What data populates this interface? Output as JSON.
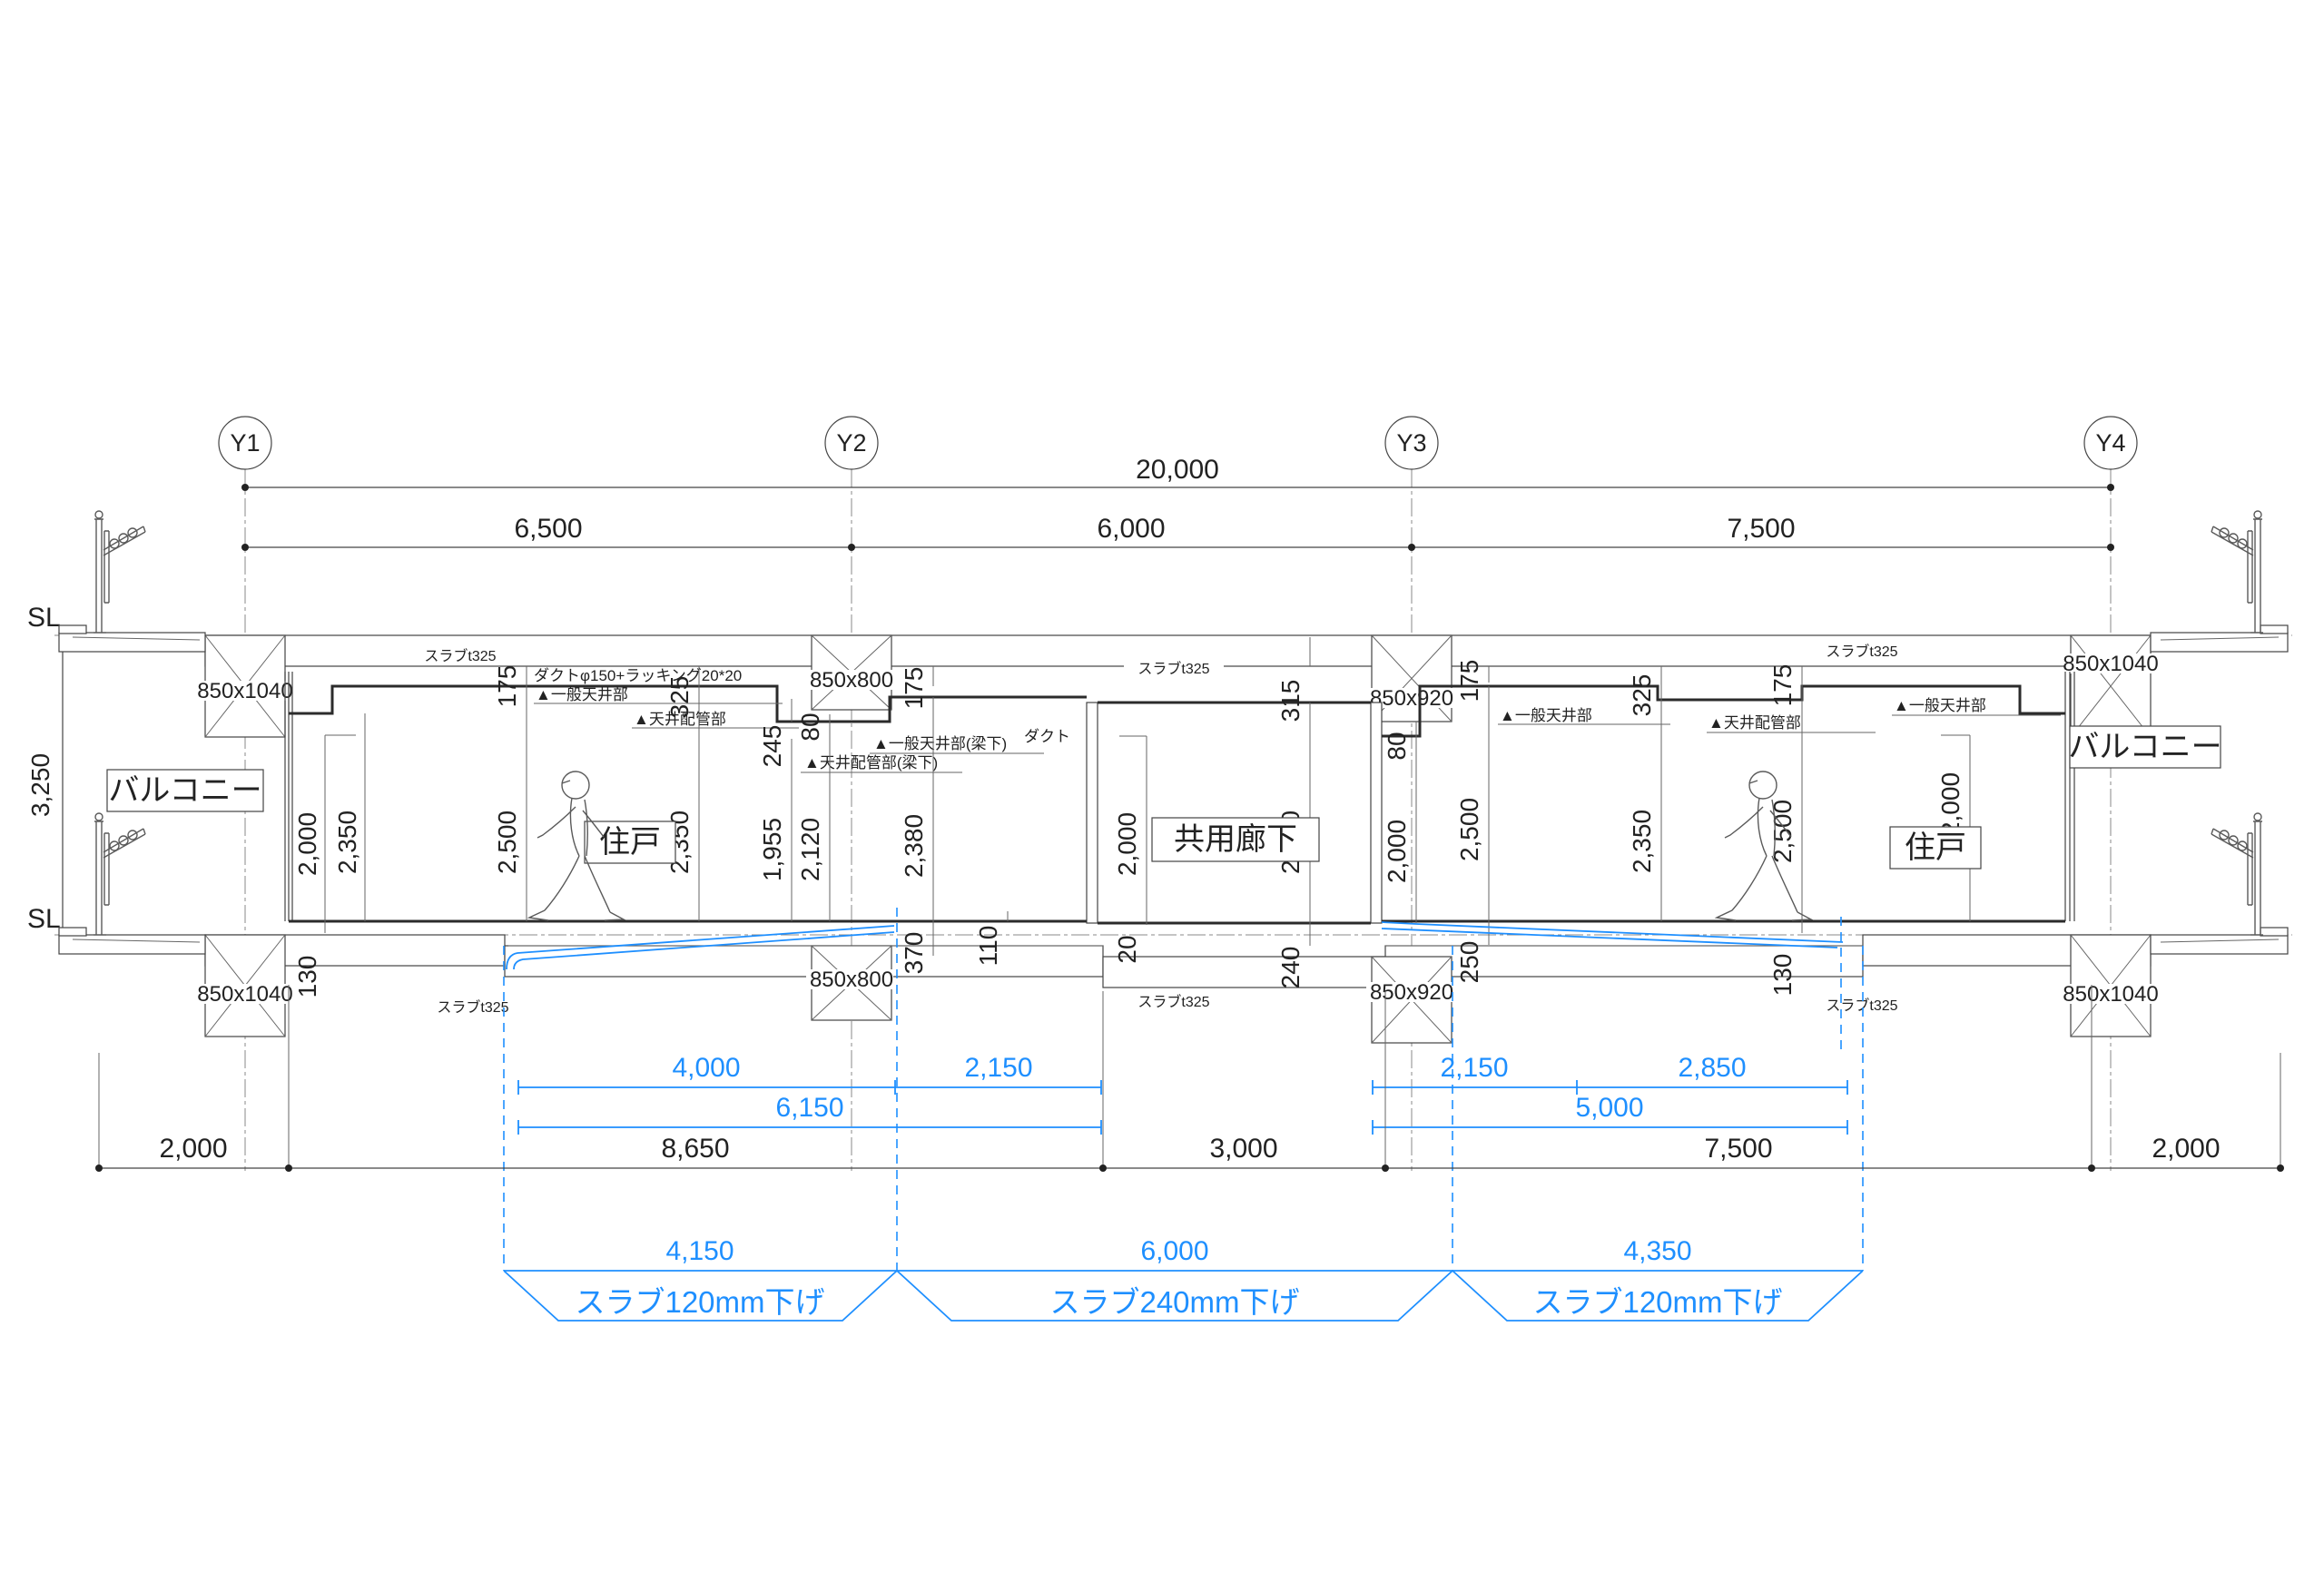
{
  "grid": {
    "labels": [
      "Y1",
      "Y2",
      "Y3",
      "Y4"
    ]
  },
  "dims": {
    "overall": "20,000",
    "spans": [
      "6,500",
      "6,000",
      "7,500"
    ],
    "height_left": "3,250",
    "sl": "SL",
    "bottom": [
      "2,000",
      "8,650",
      "3,000",
      "7,500",
      "2,000"
    ]
  },
  "rooms": {
    "balcony": "バルコニー",
    "unit": "住戸",
    "corridor": "共用廊下"
  },
  "beams": {
    "y1": "850x1040",
    "y2": "850x800",
    "y3": "850x920",
    "y4": "850x1040"
  },
  "slab": "スラブt325",
  "vdims": [
    "2,000",
    "130",
    "2,350",
    "2,500",
    "175",
    "325",
    "2,350",
    "245",
    "1,955",
    "80",
    "2,120",
    "175",
    "2,380",
    "370",
    "110",
    "2,000",
    "315",
    "2,380",
    "20",
    "240",
    "80",
    "2,000",
    "250",
    "2,500",
    "175",
    "325",
    "2,350",
    "175",
    "2,500",
    "130",
    "2,000"
  ],
  "ann": {
    "duct_run": "ダクトφ150+ラッキング20*20",
    "ceiling_general": "▲一般天井部",
    "ceiling_pipe": "▲天井配管部",
    "ceiling_general_beam": "▲一般天井部(梁下)",
    "ceiling_pipe_beam": "▲天井配管部(梁下)",
    "duct": "ダクト"
  },
  "blue_dims": {
    "left_upper": [
      "4,000",
      "2,150"
    ],
    "left_total": "6,150",
    "right_upper": [
      "2,150",
      "2,850"
    ],
    "right_total": "5,000",
    "lower": [
      "4,150",
      "6,000",
      "4,350"
    ],
    "slab_drop_left": "スラブ120mm下げ",
    "slab_drop_center": "スラブ240mm下げ",
    "slab_drop_right": "スラブ120mm下げ"
  },
  "colors": {
    "accent_blue": "#1e8fff",
    "ink": "#2b2b2b"
  }
}
